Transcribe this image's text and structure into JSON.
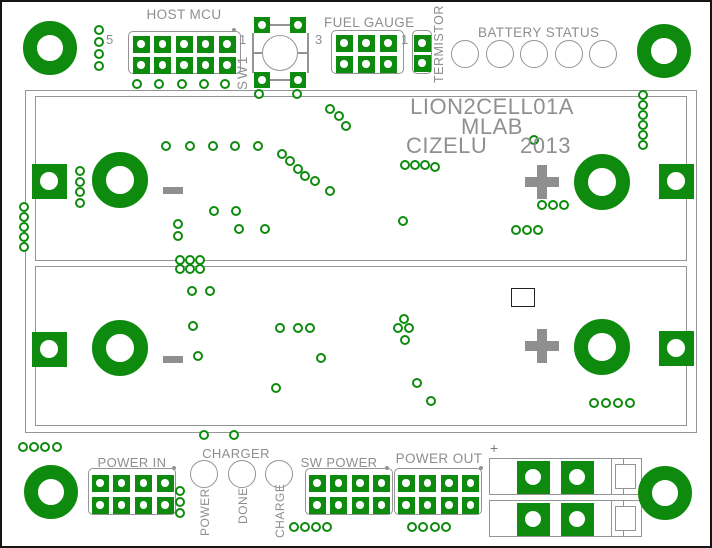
{
  "texts": {
    "host_mcu": "HOST MCU",
    "host_pin5": "5",
    "host_pin1": "1",
    "sw1": "SW1",
    "fuel_gauge": "FUEL GAUGE",
    "fg_pin3": "3",
    "fg_pin1": "1",
    "termistor": "TERMISTOR",
    "battery_status": "BATTERY STATUS",
    "title": "LION2CELL01A",
    "subtitle": "MLAB",
    "author": "CIZELU",
    "year": "2013",
    "power_in": "POWER IN",
    "charger": "CHARGER",
    "led_power": "POWER",
    "led_done": "DONE",
    "led_charge": "CHARGE",
    "sw_power": "SW POWER",
    "power_out": "POWER OUT",
    "connector_plus": "+"
  },
  "cells": [
    {
      "polarity_left": "-",
      "polarity_right": "+"
    },
    {
      "polarity_left": "-",
      "polarity_right": "+"
    }
  ],
  "colors": {
    "pad_green": "#0e8b0e",
    "silk_gray": "#949494",
    "text_gray": "#8e8e8e",
    "board_white": "#ffffff",
    "frame_black": "#151515"
  },
  "pcb": {
    "battery_outline": [
      23,
      88,
      672,
      343
    ],
    "cells": [
      [
        33,
        94,
        652,
        165
      ],
      [
        33,
        264,
        652,
        160
      ]
    ],
    "mounting_holes": [
      [
        48,
        46
      ],
      [
        662,
        49
      ],
      [
        49,
        490
      ],
      [
        663,
        491
      ]
    ],
    "terminal_rings": [
      [
        118,
        178
      ],
      [
        600,
        180
      ],
      [
        118,
        346
      ],
      [
        600,
        345
      ]
    ],
    "terminal_pads": [
      [
        47,
        179
      ],
      [
        674,
        179
      ],
      [
        47,
        347
      ],
      [
        674,
        346
      ]
    ],
    "headers": [
      {
        "id": "host-mcu",
        "cols": 5,
        "rows": 2,
        "cx": 139,
        "cy": 42,
        "dx": 21.5,
        "dy": 21,
        "outline": [
          126,
          29,
          113,
          43
        ]
      },
      {
        "id": "fuel-gauge",
        "cols": 3,
        "rows": 2,
        "cx": 342,
        "cy": 41,
        "dx": 22,
        "dy": 21,
        "outline": [
          329,
          28,
          73,
          44
        ]
      },
      {
        "id": "termistor",
        "cols": 1,
        "rows": 2,
        "cx": 420,
        "cy": 41,
        "dx": 0,
        "dy": 20,
        "outline": [
          410,
          28,
          20,
          44
        ]
      },
      {
        "id": "power-in",
        "cols": 4,
        "rows": 2,
        "cx": 98,
        "cy": 481,
        "dx": 21.7,
        "dy": 22,
        "outline": [
          86,
          466,
          88,
          47
        ]
      },
      {
        "id": "sw-power",
        "cols": 4,
        "rows": 2,
        "cx": 315,
        "cy": 481,
        "dx": 21.5,
        "dy": 22,
        "outline": [
          303,
          466,
          88,
          47
        ]
      },
      {
        "id": "power-out",
        "cols": 4,
        "rows": 2,
        "cx": 404,
        "cy": 481,
        "dx": 21.5,
        "dy": 22,
        "outline": [
          392,
          466,
          88,
          47
        ]
      }
    ],
    "sw1_pads": [
      [
        260,
        23
      ],
      [
        296,
        23
      ],
      [
        260,
        78
      ],
      [
        296,
        78
      ]
    ],
    "connector_pads": [
      [
        531,
        475
      ],
      [
        575,
        475
      ],
      [
        531,
        517
      ],
      [
        575,
        517
      ]
    ],
    "pin_dots": [
      [
        232,
        28
      ],
      [
        172,
        466
      ],
      [
        385,
        466
      ],
      [
        479,
        466
      ]
    ],
    "battery_status_leds": {
      "count": 5,
      "cx": 463,
      "cy": 52,
      "dx": 34.5,
      "r": 14
    },
    "charger_leds": [
      [
        202,
        472
      ],
      [
        240,
        472
      ],
      [
        277,
        472
      ]
    ],
    "vias": [
      [
        97,
        28
      ],
      [
        97,
        40
      ],
      [
        97,
        52
      ],
      [
        97,
        64
      ],
      [
        135,
        82
      ],
      [
        157,
        82
      ],
      [
        180,
        82
      ],
      [
        202,
        82
      ],
      [
        223,
        82
      ],
      [
        257,
        92
      ],
      [
        295,
        92
      ],
      [
        641,
        93
      ],
      [
        641,
        103
      ],
      [
        641,
        113
      ],
      [
        641,
        123
      ],
      [
        641,
        133
      ],
      [
        641,
        143
      ],
      [
        328,
        107
      ],
      [
        337,
        114
      ],
      [
        344,
        124
      ],
      [
        164,
        144
      ],
      [
        188,
        144
      ],
      [
        211,
        144
      ],
      [
        233,
        144
      ],
      [
        256,
        144
      ],
      [
        280,
        152
      ],
      [
        288,
        159
      ],
      [
        296,
        167
      ],
      [
        303,
        174
      ],
      [
        313,
        179
      ],
      [
        328,
        189
      ],
      [
        532,
        138
      ],
      [
        403,
        163
      ],
      [
        413,
        163
      ],
      [
        423,
        163
      ],
      [
        433,
        165
      ],
      [
        401,
        219
      ],
      [
        540,
        203
      ],
      [
        551,
        203
      ],
      [
        562,
        203
      ],
      [
        514,
        228
      ],
      [
        525,
        228
      ],
      [
        536,
        228
      ],
      [
        212,
        209
      ],
      [
        234,
        209
      ],
      [
        237,
        227
      ],
      [
        263,
        227
      ],
      [
        176,
        222
      ],
      [
        176,
        234
      ],
      [
        22,
        205
      ],
      [
        22,
        215
      ],
      [
        22,
        225
      ],
      [
        22,
        235
      ],
      [
        22,
        245
      ],
      [
        78,
        169
      ],
      [
        78,
        180
      ],
      [
        78,
        190
      ],
      [
        78,
        201
      ],
      [
        178,
        258
      ],
      [
        188,
        258
      ],
      [
        198,
        258
      ],
      [
        178,
        267
      ],
      [
        188,
        267
      ],
      [
        198,
        267
      ],
      [
        190,
        289
      ],
      [
        208,
        289
      ],
      [
        191,
        324
      ],
      [
        196,
        354
      ],
      [
        278,
        326
      ],
      [
        296,
        326
      ],
      [
        308,
        326
      ],
      [
        319,
        356
      ],
      [
        274,
        386
      ],
      [
        402,
        317
      ],
      [
        396,
        326
      ],
      [
        407,
        326
      ],
      [
        403,
        338
      ],
      [
        415,
        381
      ],
      [
        429,
        399
      ],
      [
        592,
        401
      ],
      [
        604,
        401
      ],
      [
        616,
        401
      ],
      [
        628,
        401
      ],
      [
        202,
        433
      ],
      [
        232,
        433
      ],
      [
        21,
        445
      ],
      [
        32,
        445
      ],
      [
        43,
        445
      ],
      [
        55,
        445
      ],
      [
        178,
        489
      ],
      [
        178,
        500
      ],
      [
        178,
        511
      ],
      [
        292,
        525
      ],
      [
        303,
        525
      ],
      [
        314,
        525
      ],
      [
        325,
        525
      ],
      [
        410,
        525
      ],
      [
        421,
        525
      ],
      [
        433,
        525
      ],
      [
        444,
        525
      ]
    ]
  }
}
